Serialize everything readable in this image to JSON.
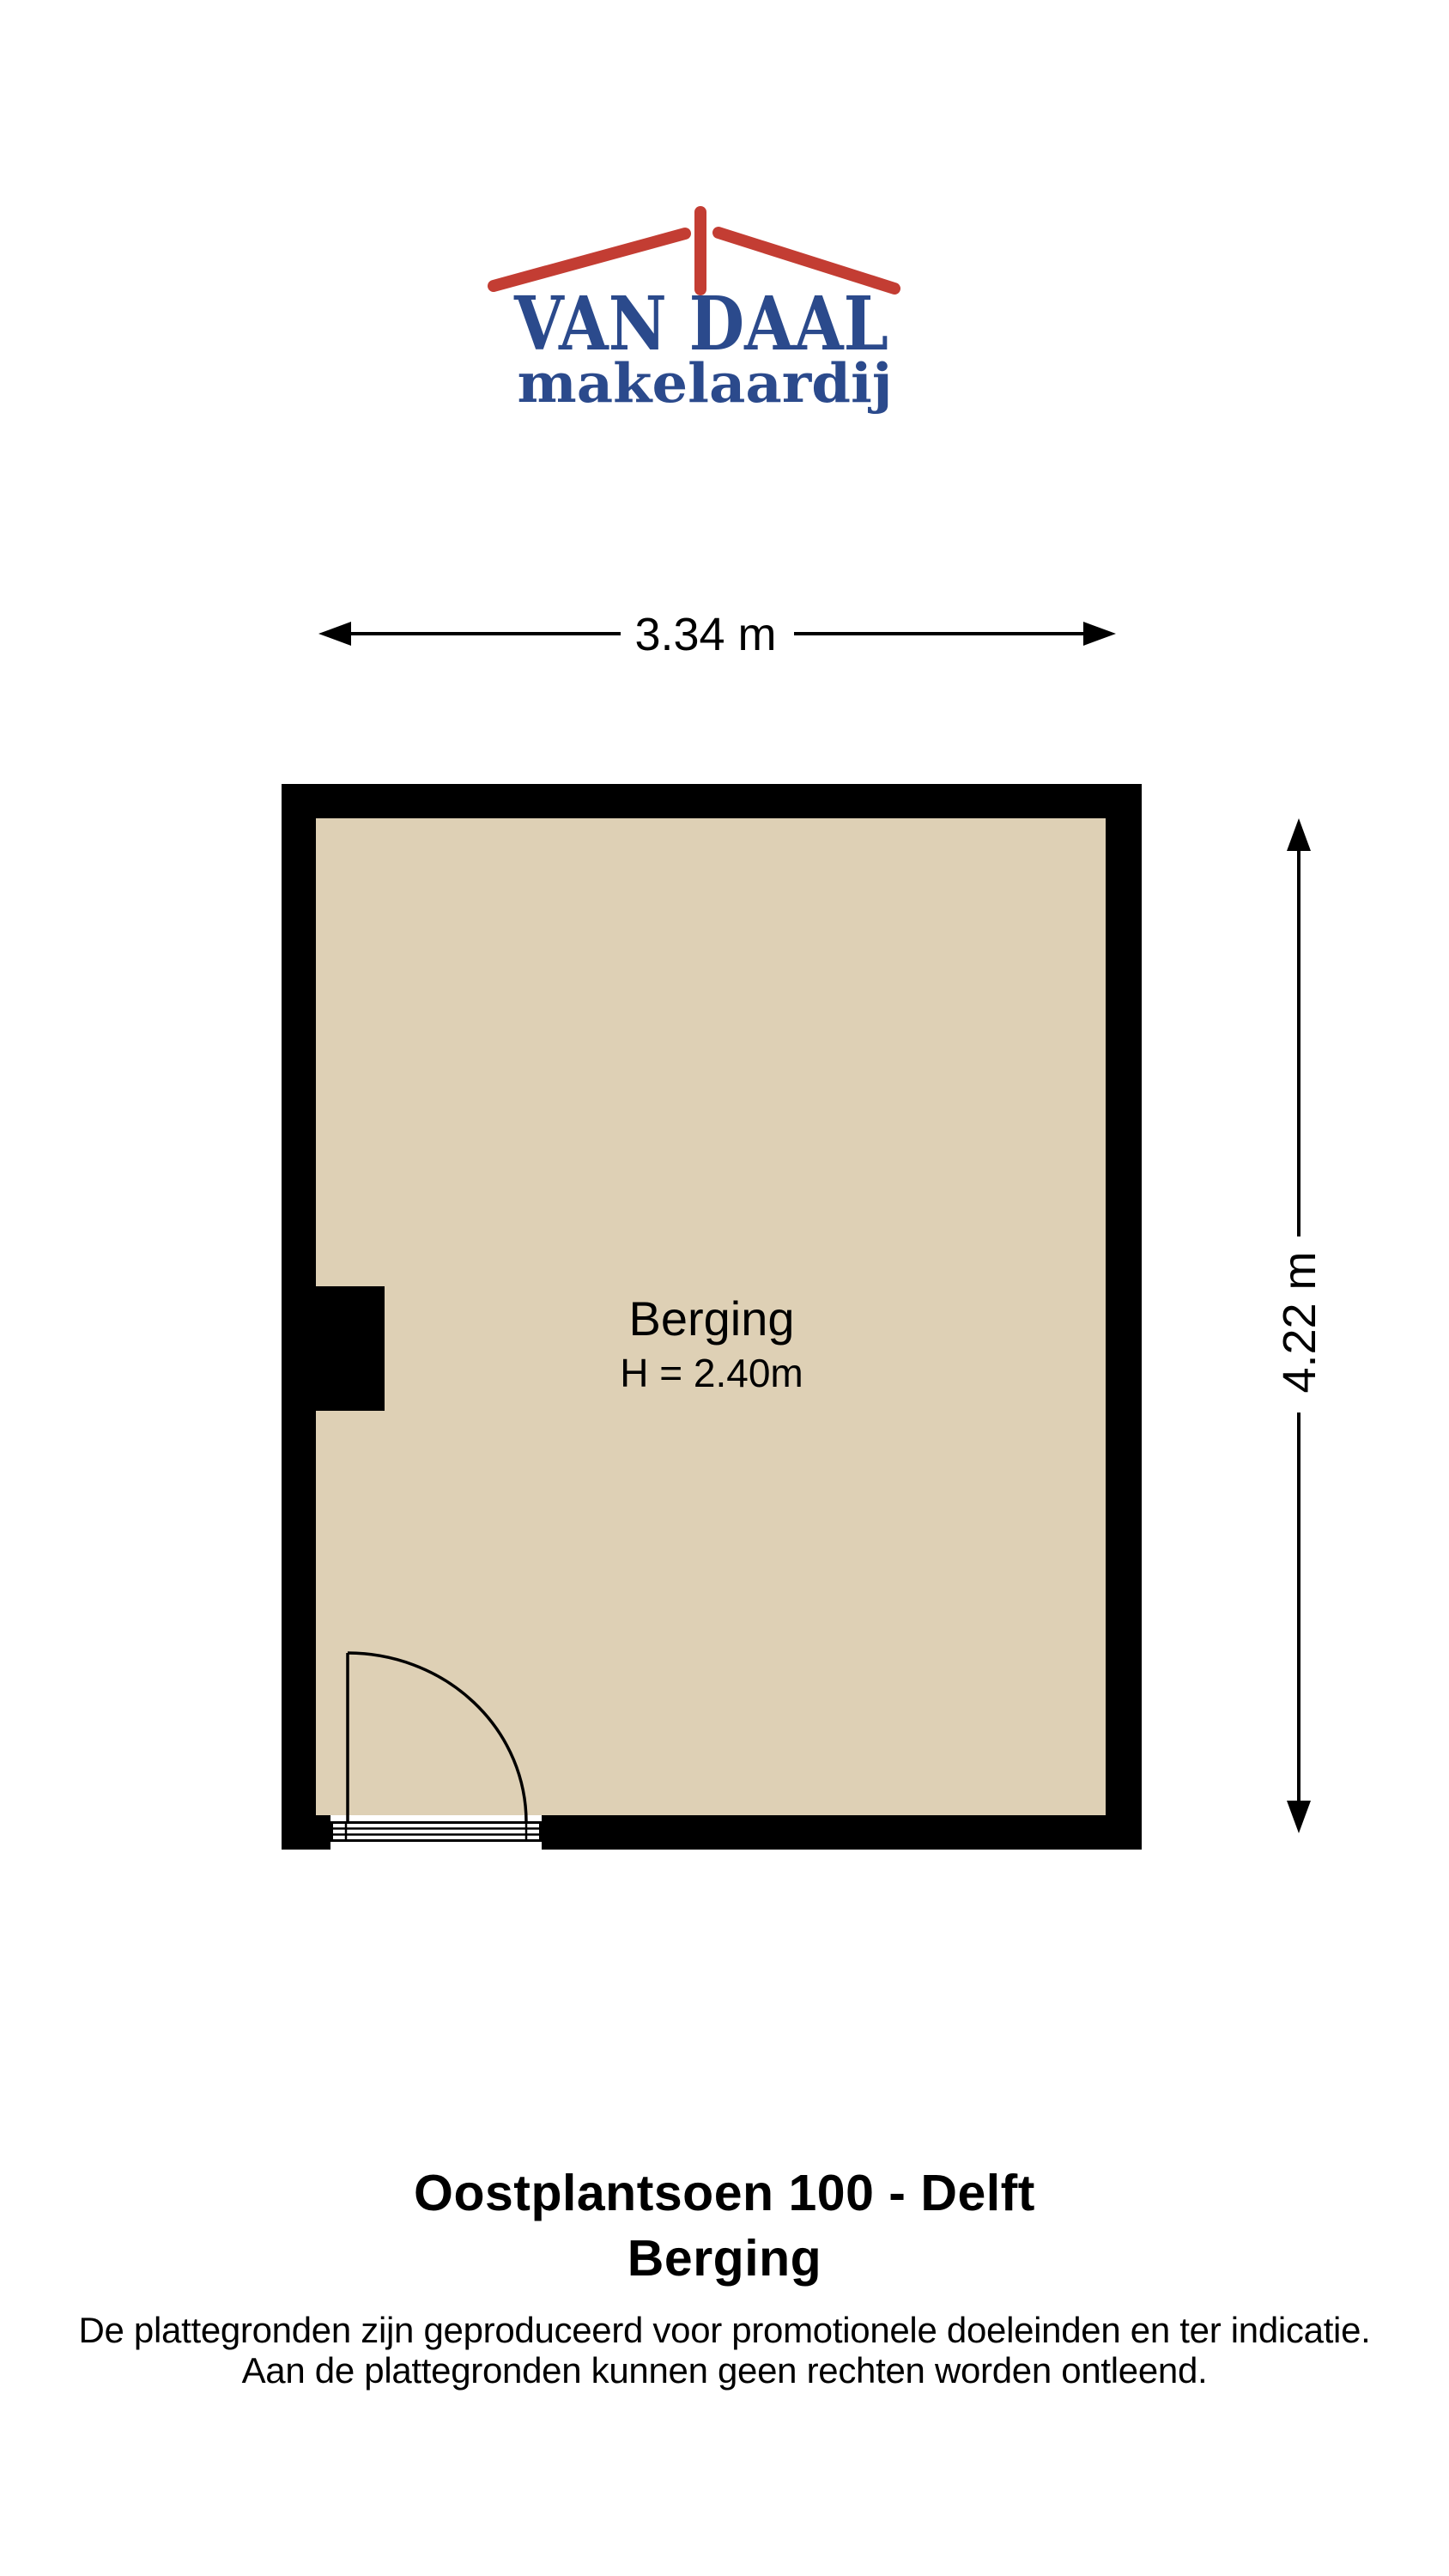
{
  "logo": {
    "title": "VAN DAAL",
    "subtitle": "makelaardij",
    "brand_blue": "#2b4a8c",
    "brand_red": "#c33d33",
    "roof_icon": "roof-with-chimney"
  },
  "dimensions": {
    "width_label": "3.34 m",
    "height_label": "4.22 m"
  },
  "floorplan": {
    "room_name": "Berging",
    "ceiling_height": "H = 2.40m",
    "wall_color": "#000000",
    "floor_color": "#ded0b5"
  },
  "footer": {
    "address": "Oostplantsoen 100 - Delft",
    "plan_name": "Berging",
    "disclaimer_line1": "De plattegronden zijn geproduceerd voor promotionele doeleinden en ter indicatie.",
    "disclaimer_line2": "Aan de plattegronden kunnen geen rechten worden ontleend."
  }
}
